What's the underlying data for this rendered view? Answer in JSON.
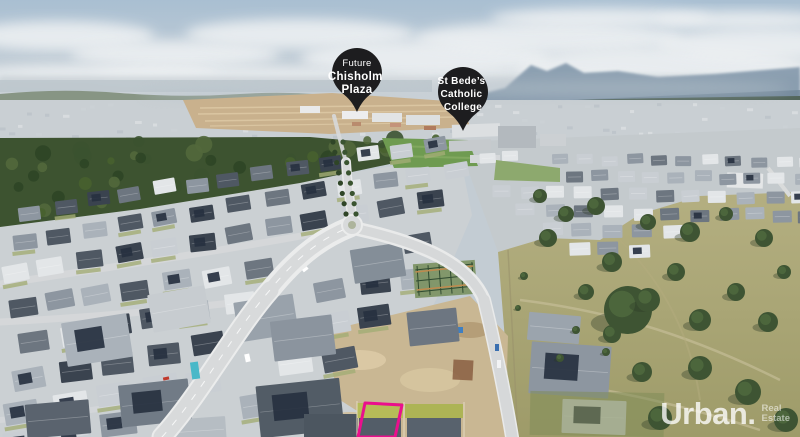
{
  "pins": [
    {
      "id": "chisholm-plaza",
      "line1": "Future",
      "line2": "Chisholm",
      "line3": "Plaza"
    },
    {
      "id": "st-bedes",
      "line1": "St Bede’s",
      "line2": "Catholic",
      "line3": "College"
    }
  ],
  "watermark": {
    "brand": "Urban.",
    "tagline_line1": "Real",
    "tagline_line2": "Estate"
  },
  "colors": {
    "pin_fill": "#1d1d1f",
    "pin_text": "#ffffff",
    "property_boundary": "#ea0f8d",
    "watermark_text": "#ffffff"
  }
}
